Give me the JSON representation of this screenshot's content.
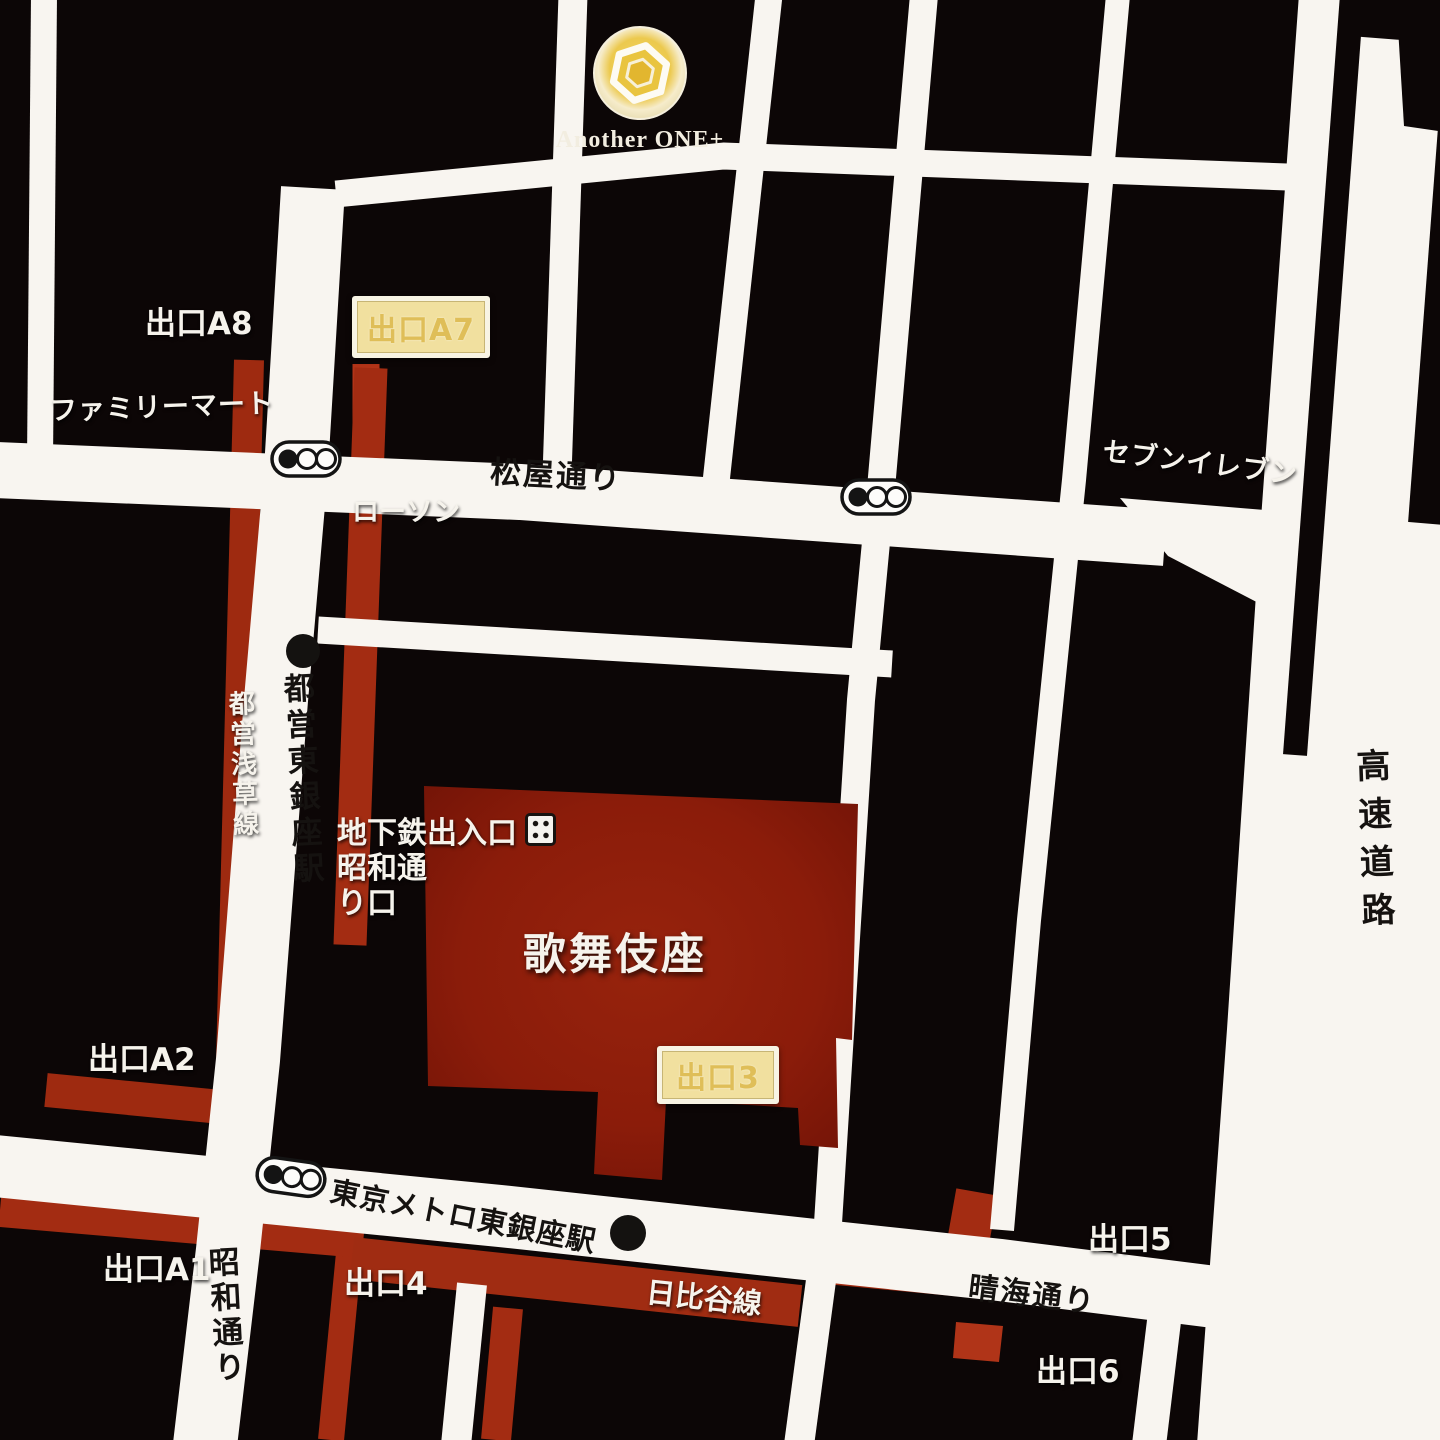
{
  "logo": {
    "text": "Another ONE+",
    "icon": "hex-coin-icon"
  },
  "exits": {
    "a8": "出口A8",
    "a7": "出口A7",
    "a2": "出口A2",
    "a1": "出口A1",
    "e3": "出口3",
    "e4": "出口4",
    "e5": "出口5",
    "e6": "出口6"
  },
  "stores": {
    "familymart": "ファミリーマート",
    "lawson": "ローソン",
    "seven_eleven": "セブンイレブン"
  },
  "roads": {
    "matsuya_dori": "松屋通り",
    "harumi_dori": "晴海通り",
    "showa_dori": "昭和通り",
    "expressway": "高速道路"
  },
  "transit": {
    "toei_asakusa_line": "都営浅草線",
    "toei_higashi_ginza_station": "都営東銀座駅",
    "tokyo_metro_higashi_ginza_station": "東京メトロ東銀座駅",
    "hibiya_line": "日比谷線"
  },
  "poi": {
    "kabukiza": "歌舞伎座",
    "subway_entrance": "地下鉄出入口",
    "showa_dori_entrance": "昭和通\nり口"
  },
  "icons": {
    "traffic_light": "traffic-signal-icon",
    "station_marker": "station-dot-icon",
    "subway_gate": "subway-gate-icon",
    "logo_mark": "hex-coin-icon"
  },
  "colors": {
    "background": "#0c0606",
    "road": "#f8f5f0",
    "subway_red": "#a32c12",
    "kabukiza_red": "#8b1c0a",
    "badge_bg": "#f1e09f",
    "badge_text": "#dfbe58",
    "logo_gold": "#ecc94e"
  }
}
